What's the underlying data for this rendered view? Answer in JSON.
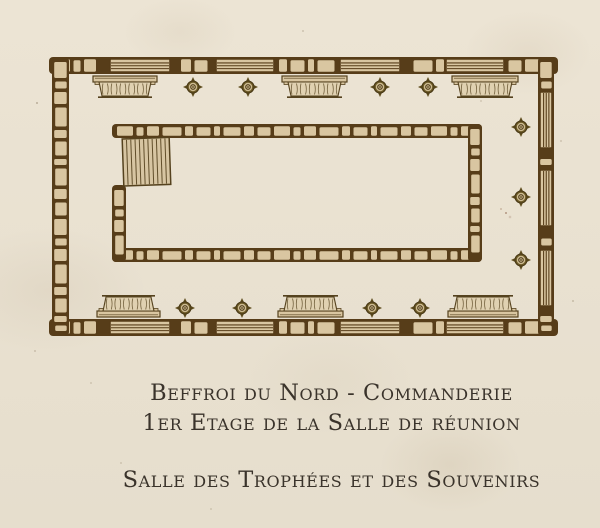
{
  "map_caption": {
    "line1": "Beffroi du Nord - Commanderie",
    "line2": "1er Etage de la Salle de réunion",
    "line3": "Salle des Trophées et des Souvenirs"
  },
  "colors": {
    "parchment": "#ebe3d3",
    "wall_brown": "#573d19",
    "stone_fill": "#d9c6a1",
    "outline": "#55421e",
    "case_fill": "#e0d1b1",
    "stair_fill": "#d7c5a2",
    "boss_dark": "#5f4e20",
    "boss_mid": "#6a5824",
    "boss_light": "#cdbb92",
    "caption_text": "#3a332b"
  },
  "plan": {
    "canvas": {
      "width": 600,
      "height": 376
    },
    "walls": [
      {
        "name": "outer-wall-top",
        "x": 49,
        "y": 57,
        "len": 509,
        "th": 17,
        "dir": "h",
        "beams": [
          [
            110,
            170
          ],
          [
            216,
            274
          ],
          [
            340,
            400
          ],
          [
            446,
            504
          ]
        ]
      },
      {
        "name": "outer-wall-bottom",
        "x": 49,
        "y": 319,
        "len": 509,
        "th": 17,
        "dir": "h",
        "beams": [
          [
            110,
            170
          ],
          [
            216,
            274
          ],
          [
            340,
            400
          ],
          [
            446,
            504
          ]
        ]
      },
      {
        "name": "outer-wall-left",
        "x": 52,
        "y": 57,
        "len": 279,
        "th": 17,
        "dir": "v",
        "beams": []
      },
      {
        "name": "outer-wall-right",
        "x": 538,
        "y": 57,
        "len": 279,
        "th": 16,
        "dir": "v",
        "beams": [
          [
            92,
            148
          ],
          [
            170,
            226
          ],
          [
            250,
            306
          ]
        ]
      },
      {
        "name": "inner-wall-top",
        "x": 112,
        "y": 124,
        "len": 370,
        "th": 14,
        "dir": "h",
        "beams": []
      },
      {
        "name": "inner-wall-bottom",
        "x": 112,
        "y": 248,
        "len": 370,
        "th": 14,
        "dir": "h",
        "beams": []
      },
      {
        "name": "inner-wall-left",
        "x": 112,
        "y": 185,
        "len": 77,
        "th": 14,
        "dir": "v",
        "beams": []
      },
      {
        "name": "inner-wall-right",
        "x": 468,
        "y": 124,
        "len": 138,
        "th": 14,
        "dir": "v",
        "beams": []
      }
    ],
    "staircase": {
      "x": 123,
      "y": 139,
      "w": 47,
      "h": 47,
      "steps": 11,
      "tilt_deg": -2
    },
    "display_cases": {
      "height": 20,
      "top_y": 76,
      "bottom_y": 297,
      "top": [
        {
          "x": 93,
          "w": 64
        },
        {
          "x": 282,
          "w": 65
        },
        {
          "x": 452,
          "w": 66
        }
      ],
      "bottom": [
        {
          "x": 97,
          "w": 63
        },
        {
          "x": 278,
          "w": 65
        },
        {
          "x": 448,
          "w": 70
        }
      ]
    },
    "bosses": {
      "top": [
        [
          193,
          87
        ],
        [
          248,
          87
        ],
        [
          380,
          87
        ],
        [
          428,
          87
        ]
      ],
      "bottom": [
        [
          185,
          308
        ],
        [
          242,
          308
        ],
        [
          372,
          308
        ],
        [
          420,
          308
        ]
      ],
      "right": [
        [
          521,
          127
        ],
        [
          521,
          197
        ],
        [
          521,
          260
        ]
      ]
    }
  }
}
